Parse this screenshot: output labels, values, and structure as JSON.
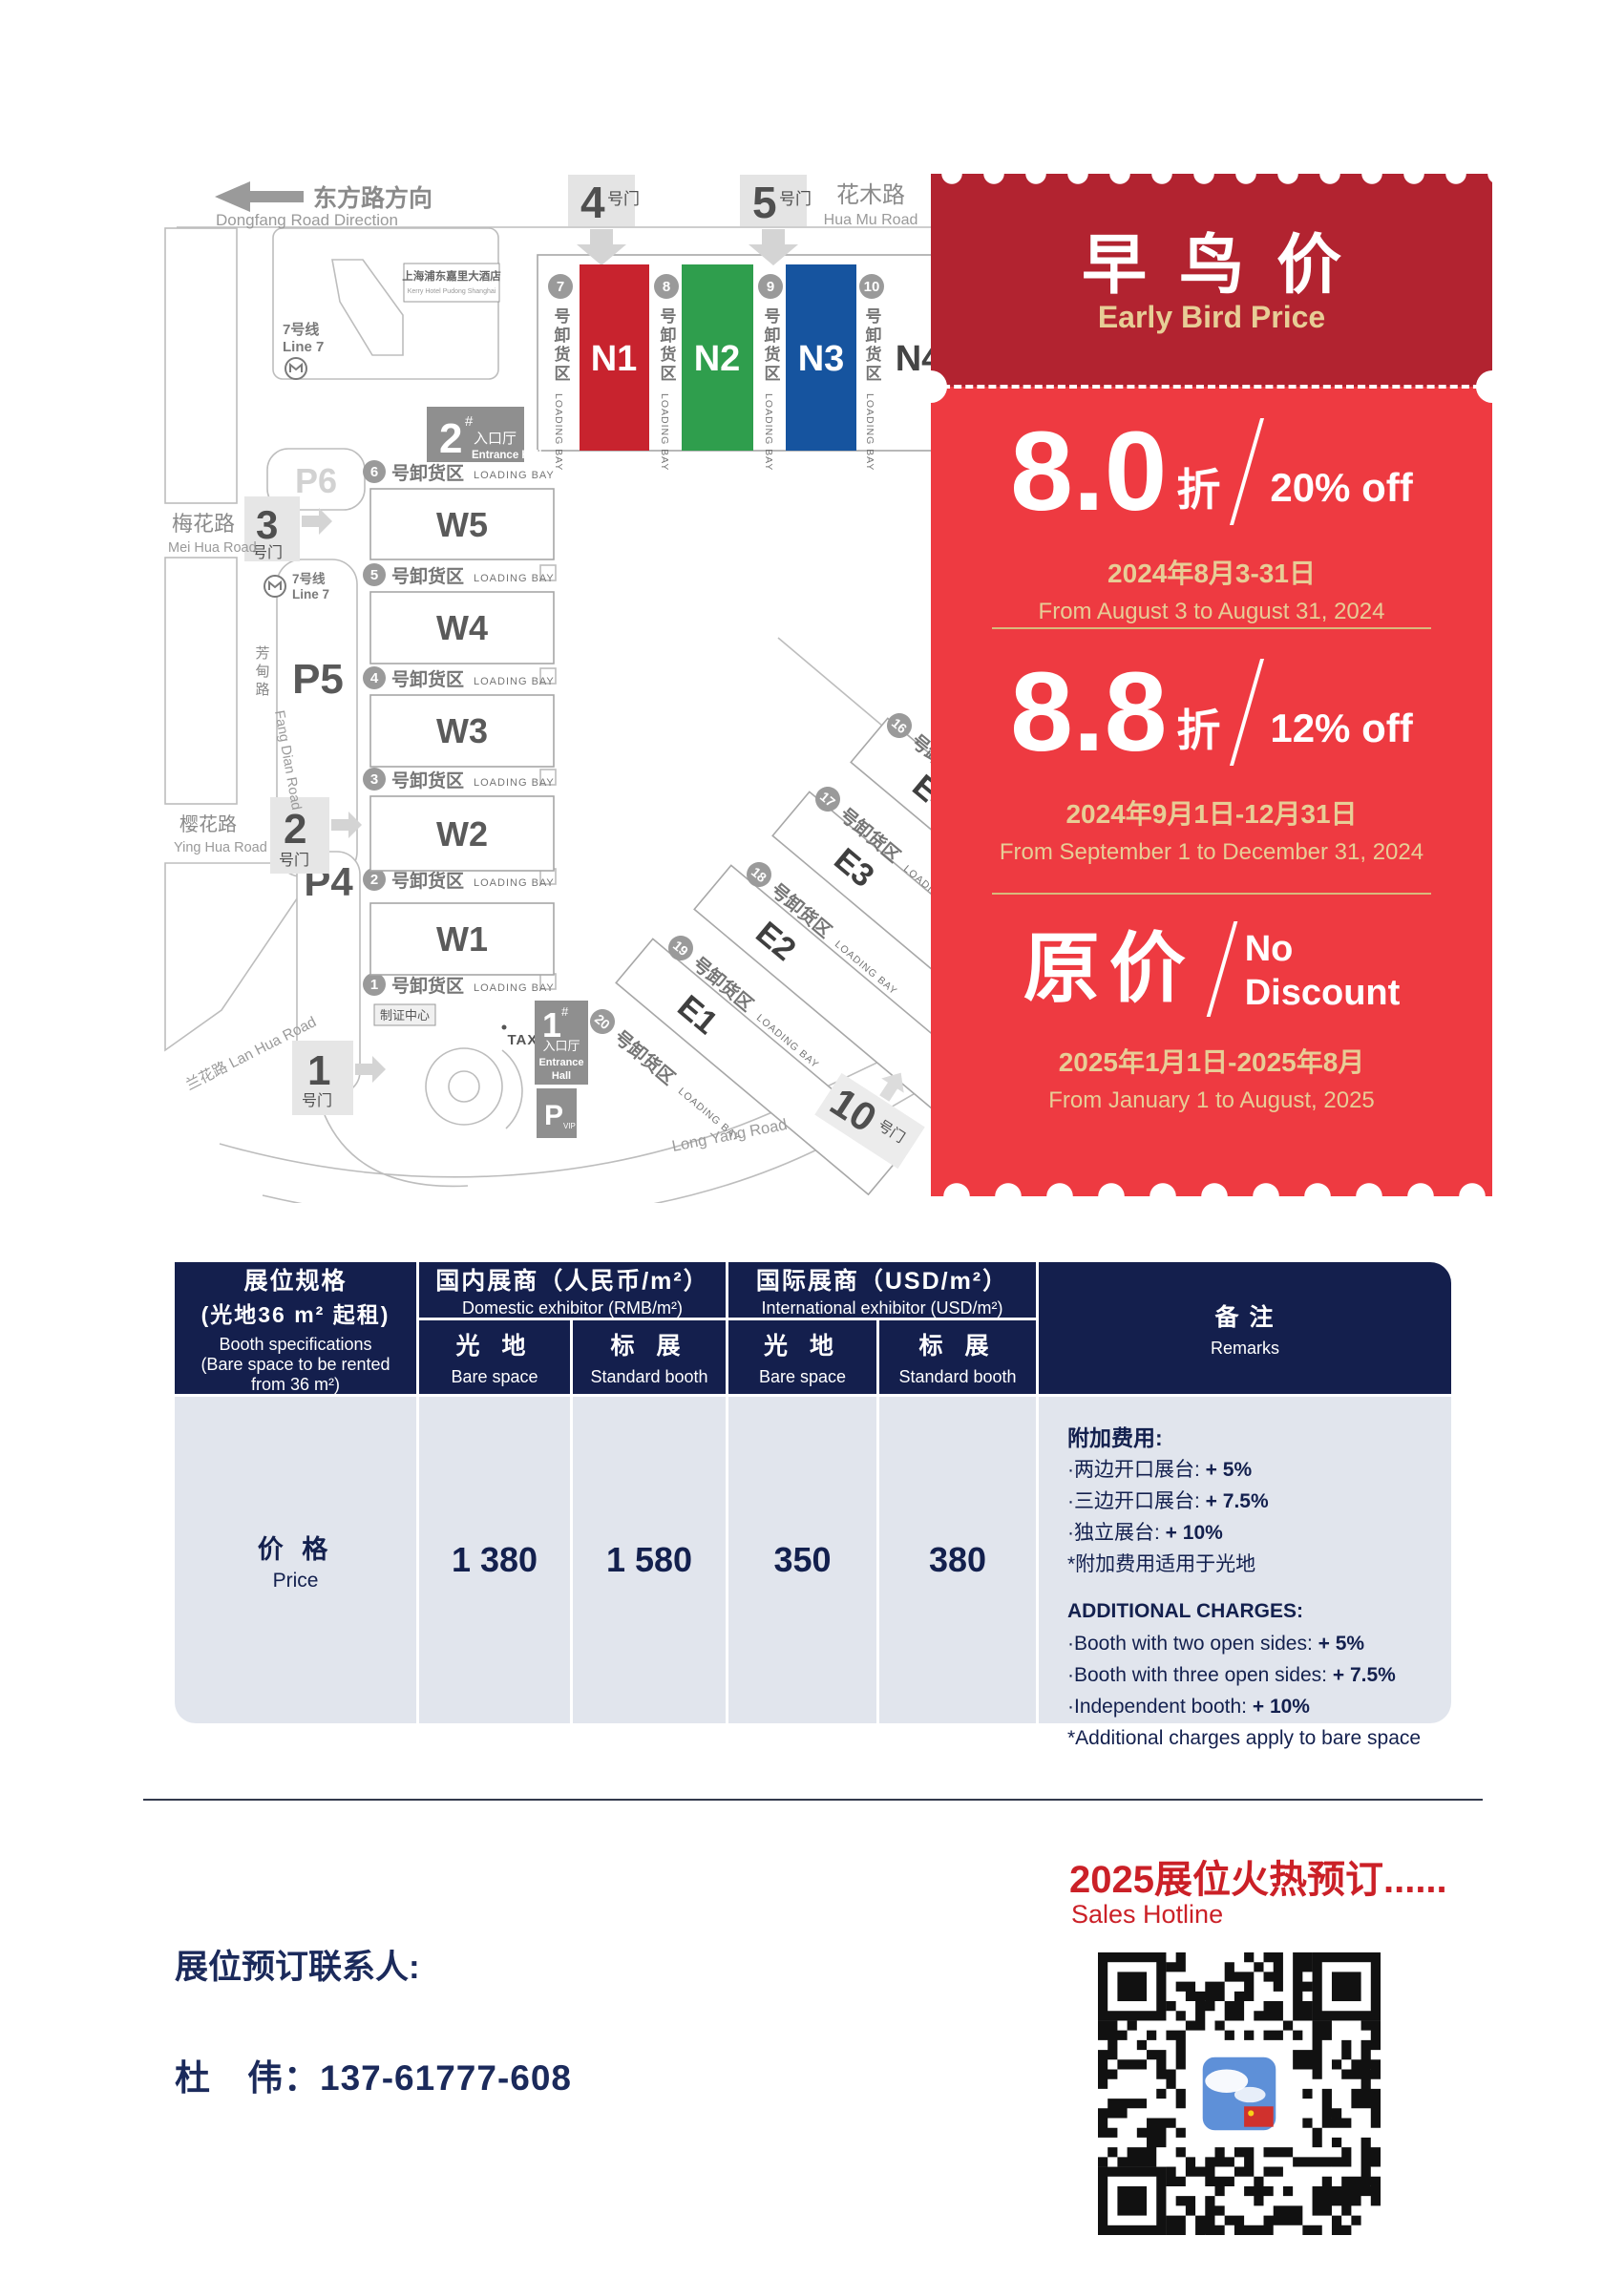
{
  "colors": {
    "accent_red": "#ee3a41",
    "dark_red": "#b22330",
    "navy": "#141f4d",
    "gold": "#e7cd96",
    "table_body": "#e1e5ed",
    "footer_red": "#cb2027",
    "hall_n1": "#c8232e",
    "hall_n2": "#2f9e4d",
    "hall_n3": "#16549f"
  },
  "map": {
    "direction_cn": "东方路方向",
    "direction_en": "Dongfang Road Direction",
    "huamu_cn": "花木路",
    "huamu_en": "Hua Mu Road",
    "meihua_cn": "梅花路",
    "meihua_en": "Mei Hua Road",
    "yinghua_cn": "樱花路",
    "yinghua_en": "Ying Hua Road",
    "lanhua": "兰花路 Lan Hua Road",
    "fangdian_cn": "芳甸路",
    "fangdian_en": "Fang Dian Road",
    "longyang": "Long Yang Road",
    "hotel_cn": "上海浦东嘉里大酒店",
    "hotel_en": "Kerry Hotel Pudong Shanghai",
    "line7_cn": "7号线",
    "line7_en": "Line 7",
    "bay_cn": "号卸货区",
    "bay_en": "LOADING BAY",
    "gate_suffix": "号门",
    "gates": {
      "g1": "1",
      "g2": "2",
      "g3": "3",
      "g4": "4",
      "g5": "5",
      "g10": "10"
    },
    "parking": {
      "p4": "P4",
      "p5": "P5",
      "p6": "P6"
    },
    "vip_p": "P",
    "vip": "VIP",
    "taxi": "TAXI",
    "cert": "制证中心",
    "ent1_num": "1",
    "ent2_num": "2",
    "ent_hash": "#",
    "ent_cn": "入口厅",
    "ent_en": "Entrance Hall",
    "ent1_en1": "Entrance",
    "ent1_en2": "Hall",
    "n_halls": [
      {
        "label": "N1",
        "color": "#c8232e"
      },
      {
        "label": "N2",
        "color": "#2f9e4d"
      },
      {
        "label": "N3",
        "color": "#16549f"
      },
      {
        "label": "N4",
        "color": "#ffffff"
      }
    ],
    "n_bays": [
      "7",
      "8",
      "9",
      "10"
    ],
    "w_halls": [
      "W5",
      "W4",
      "W3",
      "W2",
      "W1"
    ],
    "w_bays": [
      "6",
      "5",
      "4",
      "3",
      "2",
      "1"
    ],
    "e_halls": [
      "E1",
      "E2",
      "E3",
      "E4"
    ],
    "e_bays": [
      "20",
      "19",
      "18",
      "17",
      "16"
    ]
  },
  "ticket": {
    "title_cn": "早鸟价",
    "title_en": "Early Bird Price",
    "tier1": {
      "big": "8.0",
      "unit": "折",
      "off": "20% off",
      "date_cn": "2024年8月3-31日",
      "date_en": "From August 3 to August 31, 2024"
    },
    "tier2": {
      "big": "8.8",
      "unit": "折",
      "off": "12% off",
      "date_cn": "2024年9月1日-12月31日",
      "date_en": "From September 1 to December 31, 2024"
    },
    "tier3": {
      "big": "原价",
      "off1": "No",
      "off2": "Discount",
      "date_cn": "2025年1月1日-2025年8月",
      "date_en": "From January 1 to August, 2025"
    }
  },
  "table": {
    "spec_l1": "展位规格",
    "spec_l2": "(光地36 m² 起租)",
    "spec_l3": "Booth specifications",
    "spec_l4": "(Bare space to be rented",
    "spec_l5": "from 36 m²)",
    "dom_cn": "国内展商（人民币/m²）",
    "dom_en": "Domestic exhibitor (RMB/m²)",
    "intl_cn": "国际展商（USD/m²）",
    "intl_en": "International exhibitor (USD/m²)",
    "bare_cn": "光 地",
    "bare_en": "Bare space",
    "std_cn": "标 展",
    "std_en": "Standard booth",
    "remarks_cn": "备 注",
    "remarks_en": "Remarks",
    "price_cn": "价 格",
    "price_en": "Price",
    "values": [
      "1 380",
      "1 580",
      "350",
      "380"
    ],
    "add_cn_title": "附加费用:",
    "add_cn": [
      {
        "t": "·两边开口展台: ",
        "v": "+ 5%"
      },
      {
        "t": "·三边开口展台: ",
        "v": "+ 7.5%"
      },
      {
        "t": "·独立展台: ",
        "v": "+ 10%"
      },
      {
        "t": "*附加费用适用于光地",
        "v": ""
      }
    ],
    "add_en_title": "ADDITIONAL CHARGES:",
    "add_en": [
      {
        "t": "·Booth with two open sides: ",
        "v": "+ 5%"
      },
      {
        "t": "·Booth with three open sides: ",
        "v": "+ 7.5%"
      },
      {
        "t": "·Independent booth: ",
        "v": "+ 10%"
      },
      {
        "t": "*Additional charges apply to bare space",
        "v": ""
      }
    ]
  },
  "footer": {
    "hot": "2025展位火热预订......",
    "hotline": "Sales Hotline",
    "contact_label": "展位预订联系人:",
    "contact": "杜　伟：137-61777-608"
  }
}
